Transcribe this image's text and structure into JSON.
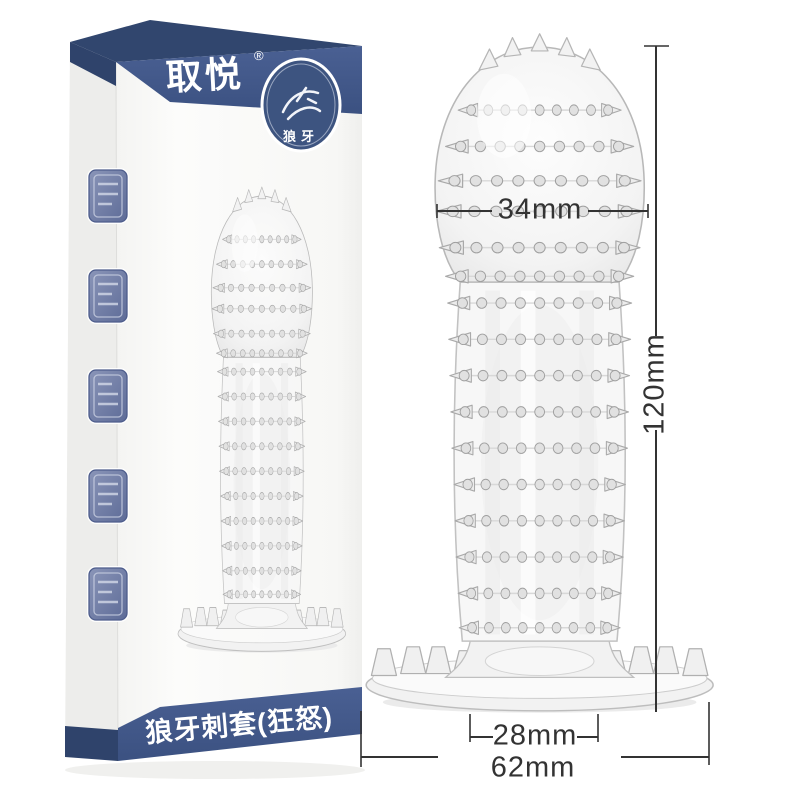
{
  "scene": {
    "background": "#ffffff",
    "description_domain": "product photo with dimension annotations"
  },
  "box": {
    "brand_logo": "取悦",
    "registered_mark": "®",
    "emblem_text": "狼牙",
    "bottom_banner": "狼牙刺套(狂怒)",
    "band_color": "#41588a",
    "seal_badge_count": "5"
  },
  "annotations": {
    "head_diameter": "34mm",
    "length": "120mm",
    "inner_diameter": "28mm",
    "base_diameter": "62mm",
    "line_color": "#333333"
  }
}
